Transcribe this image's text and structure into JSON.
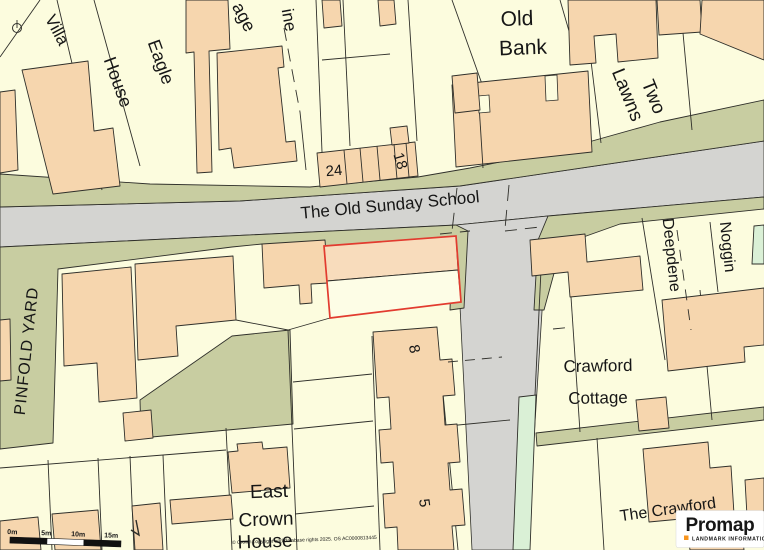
{
  "labels": {
    "villa": "Villa",
    "eagle1": "Eagle",
    "eagle2": "House",
    "cottage_partial": "age",
    "lane_partial": "ine",
    "no24": "24",
    "no18": "18",
    "old_bank1": "Old",
    "old_bank2": "Bank",
    "two_lawns1": "Two",
    "two_lawns2": "Lawns",
    "road_name": "The Old Sunday School",
    "pinfold_yard": "PINFOLD YARD",
    "deepdene": "Deepdene",
    "noggin": "Noggin",
    "crawford1": "Crawford",
    "crawford2": "Cottage",
    "no8": "8",
    "no5": "5",
    "east1": "East",
    "east2": "Crown",
    "east3": "House",
    "the_crawford": "The Crawford"
  },
  "scale_bar": {
    "m0": "0m",
    "m5": "5m",
    "m10": "10m",
    "m15": "15m"
  },
  "copyright": "© Crown copyright and database rights 2025. OS AC0000813445",
  "logo": {
    "brand": "Promap",
    "tagline": "LANDMARK INFORMATION"
  },
  "colors": {
    "road": "#D4D4D1",
    "plot": "#FCFCDE",
    "building": "#F6D6AE",
    "selected_building": "#F8DCBC",
    "verge_green": "#C8CDA1",
    "mint_green": "#DAF0D6",
    "outline": "#2F2F2A",
    "selection_red": "#E23B2F",
    "brand_navy": "#232D5C",
    "brand_orange": "#F7941D"
  }
}
